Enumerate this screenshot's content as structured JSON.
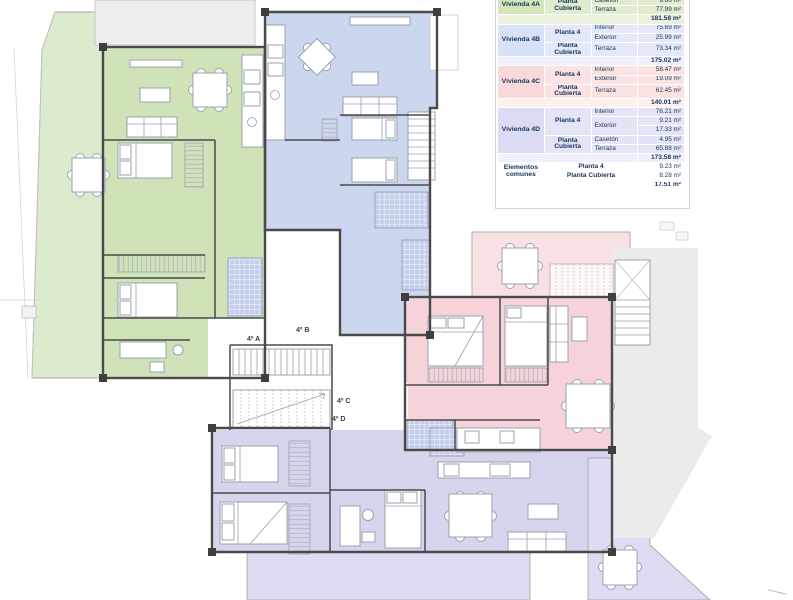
{
  "title": "Planta 4 - floor plan with dwelling areas table",
  "colors": {
    "unit_4a": "#cfe2b8",
    "unit_4b": "#ccd6ef",
    "unit_4c": "#f5d3d8",
    "unit_4d": "#d6d5ee",
    "table_text": "#17365d",
    "walls": "#4a4a4a"
  },
  "plan_labels": {
    "u4a": "4º A",
    "u4b": "4º B",
    "u4c": "4º C",
    "u4d": "4º D"
  },
  "t": {
    "a4a_label": "Vivienda 4A",
    "a4a_pc": "Planta Cubierta",
    "a4a_r1c": "Casetón",
    "a4a_r1v": "9.86 m²",
    "a4a_r2c": "Terraza",
    "a4a_r2v": "77.99 m²",
    "a4a_total": "181.58 m²",
    "a4b_label": "Vivienda 4B",
    "a4b_p4": "Planta 4",
    "a4b_r1c": "Interior",
    "a4b_r1v": "75.69 m²",
    "a4b_r2c": "Exterior",
    "a4b_r2v": "25.99 m²",
    "a4b_pc": "Planta Cubierta",
    "a4b_r3c": "Terraza",
    "a4b_r3v": "73.34 m²",
    "a4b_total": "175.02 m²",
    "a4c_label": "Vivienda 4C",
    "a4c_p4": "Planta 4",
    "a4c_r1c": "Interior",
    "a4c_r1v": "58.47 m²",
    "a4c_r2c": "Exterior",
    "a4c_r2v": "19.09 m²",
    "a4c_pc": "Planta Cubierta",
    "a4c_r3c": "Terraza",
    "a4c_r3v": "62.45 m²",
    "a4c_total": "140.01 m²",
    "a4d_label": "Vivienda 4D",
    "a4d_p4": "Planta 4",
    "a4d_r1c": "Interior",
    "a4d_r1v": "76.21 m²",
    "a4d_r2c": "Exterior",
    "a4d_r2v": "9.21 m²",
    "a4d_r3v": "17.33 m²",
    "a4d_pc": "Planta Cubierta",
    "a4d_r4c": "Casetón",
    "a4d_r4v": "4.95 m²",
    "a4d_r5c": "Terraza",
    "a4d_r5v": "65.88 m²",
    "a4d_total": "173.58 m²",
    "ec_label": "Elementos comunes",
    "ec_r1": "Planta 4",
    "ec_r1v": "9.23 m²",
    "ec_r2": "Planta Cubierta",
    "ec_r2v": "8.28 m²",
    "ec_total": "17.51 m²"
  }
}
